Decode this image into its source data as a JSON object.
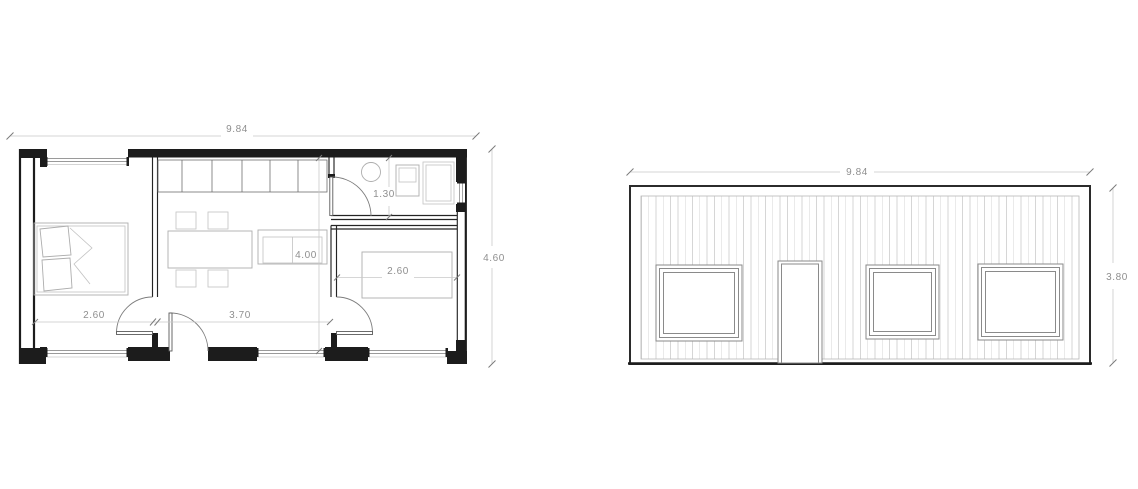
{
  "floor_plan": {
    "dimensions": {
      "overall_width": "9.84",
      "overall_depth": "4.60",
      "bathroom_width": "1.30",
      "living_depth": "4.00",
      "bedroom_right_bed": "2.60",
      "bedroom_left_width": "2.60",
      "living_width": "3.70"
    }
  },
  "elevation": {
    "dimensions": {
      "overall_width": "9.84",
      "overall_height": "3.80"
    }
  },
  "colors": {
    "background": "#ffffff",
    "wall": "#1c1c1c",
    "dimension_line": "#c9c9c9",
    "dimension_text": "#8f8f8f",
    "furniture_line": "#adadad",
    "siding_line": "#d6d6d6",
    "window_frame": "#8a8a8a"
  }
}
